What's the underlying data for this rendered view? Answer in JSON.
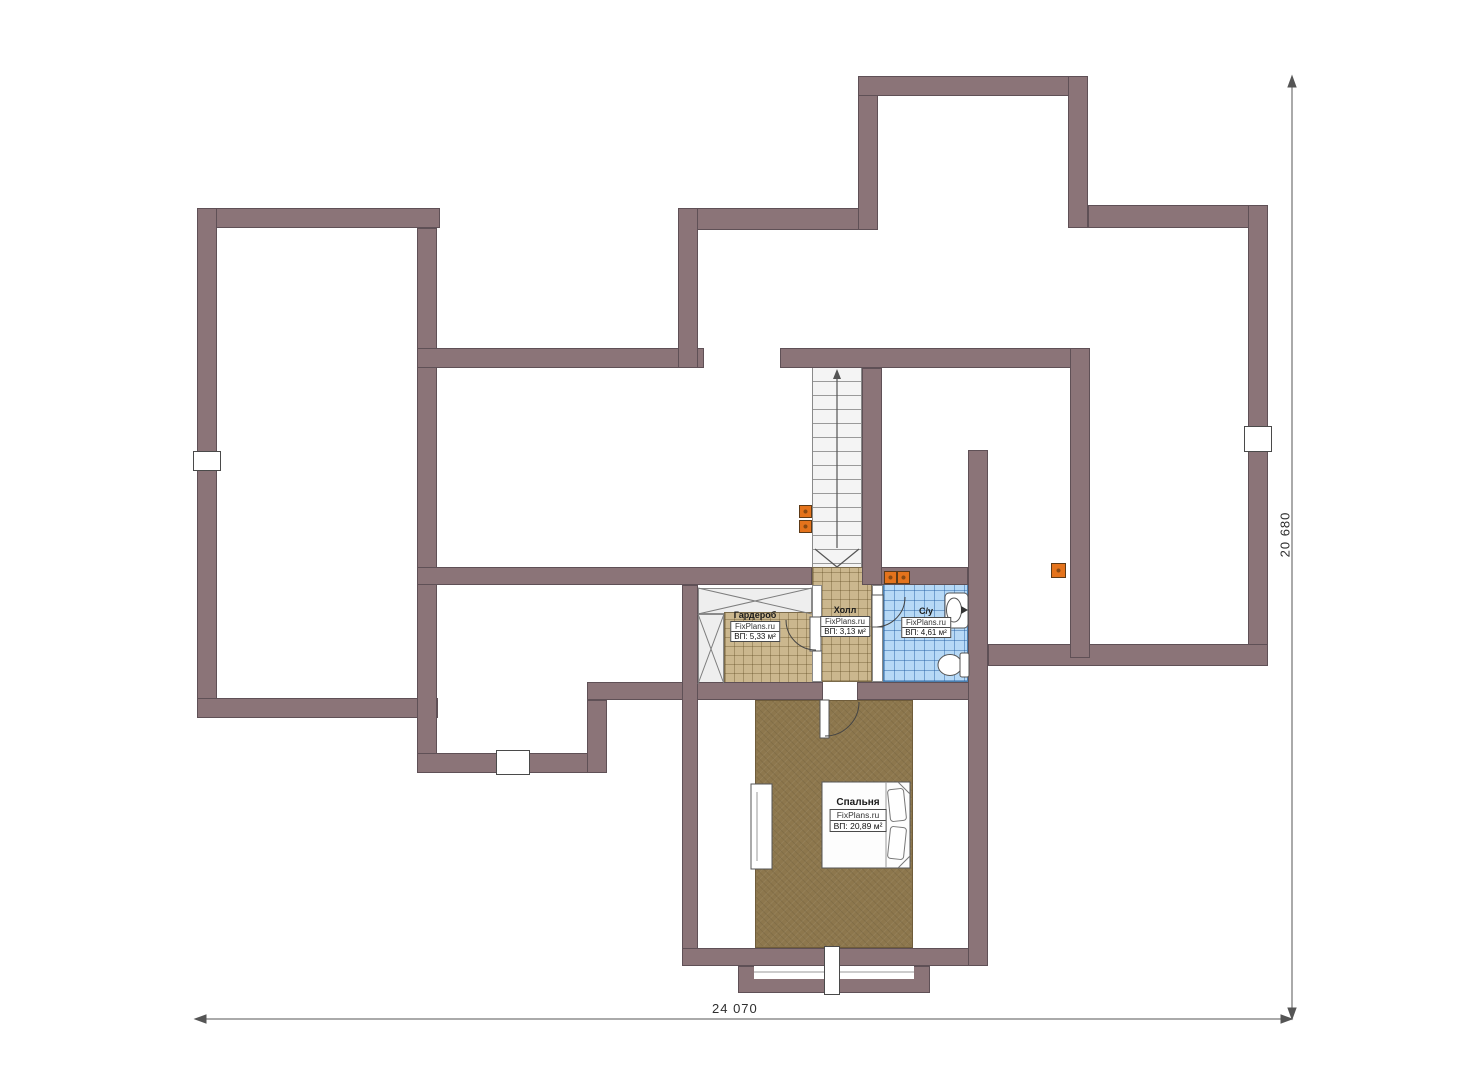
{
  "drawing": {
    "type": "floor-plan",
    "floor_name": "attic level",
    "watermark": "FixPlans.ru",
    "dimensions": {
      "bottom": "24 070",
      "right": "20 680"
    },
    "rooms": [
      {
        "name": "Гардероб",
        "brand": "FixPlans.ru",
        "area": "ВП: 5,33 м²"
      },
      {
        "name": "Холл",
        "brand": "FixPlans.ru",
        "area": "ВП: 3,13 м²"
      },
      {
        "name": "С/у",
        "brand": "FixPlans.ru",
        "area": "ВП: 4,61 м²"
      },
      {
        "name": "Спальня",
        "brand": "FixPlans.ru",
        "area": "ВП: 20,89 м²"
      }
    ],
    "stairs": {
      "treads": 14,
      "direction": "down"
    },
    "colors": {
      "wall": "#8b7478",
      "wall_edge": "#5f5056",
      "tile_beige": "#cbb78e",
      "tile_blue": "#b7d9f6",
      "carpet": "#8d774d",
      "socket": "#e4731c",
      "dim": "#555555"
    }
  }
}
